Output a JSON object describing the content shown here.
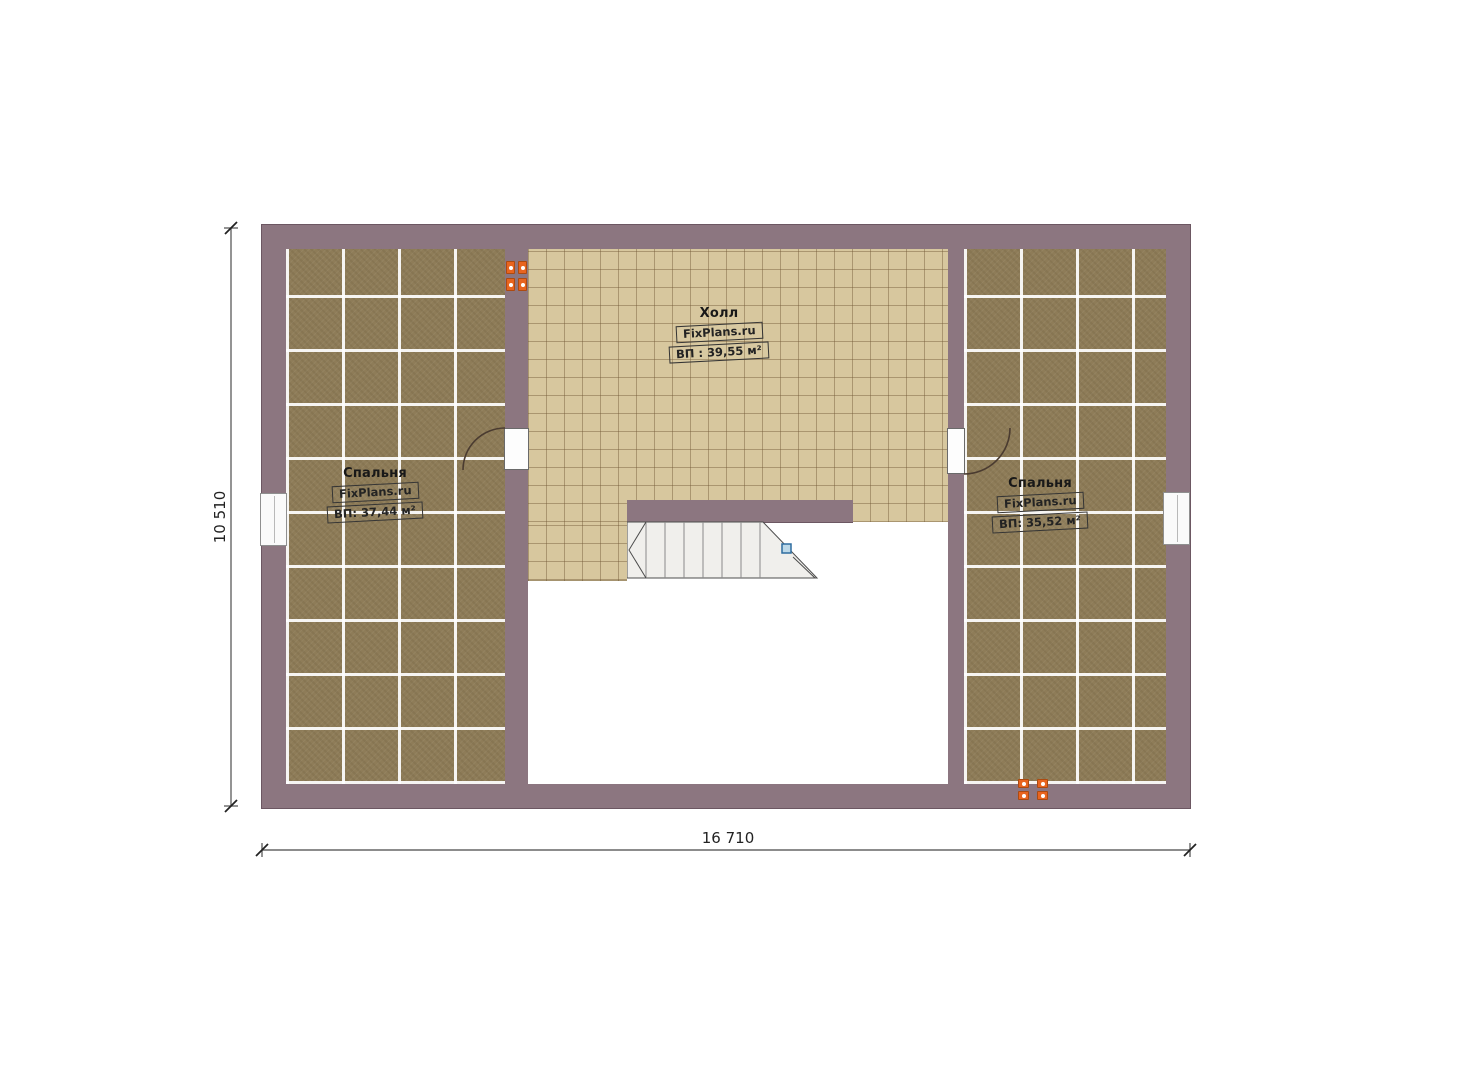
{
  "plan": {
    "type": "floor-plan",
    "brand": "FixPlans.ru",
    "dimensions": {
      "width_label": "16 710",
      "height_label": "10 510"
    },
    "rooms": {
      "bedroom_left": {
        "name": "Спальня",
        "brand": "FixPlans.ru",
        "area": "ВП: 37,44 м²"
      },
      "hall": {
        "name": "Холл",
        "brand": "FixPlans.ru",
        "area": "ВП : 39,55 м²"
      },
      "bedroom_right": {
        "name": "Спальня",
        "brand": "FixPlans.ru",
        "area": "ВП: 35,52 м²"
      }
    },
    "colors": {
      "wall": "#8c7680",
      "carpet": "#8e7c58",
      "tile": "#d7c79e",
      "stair": "#f0efec",
      "socket_orange": "#e8641f",
      "stair_marker_blue": "#2e6da0",
      "dimension_line": "#555555"
    }
  }
}
